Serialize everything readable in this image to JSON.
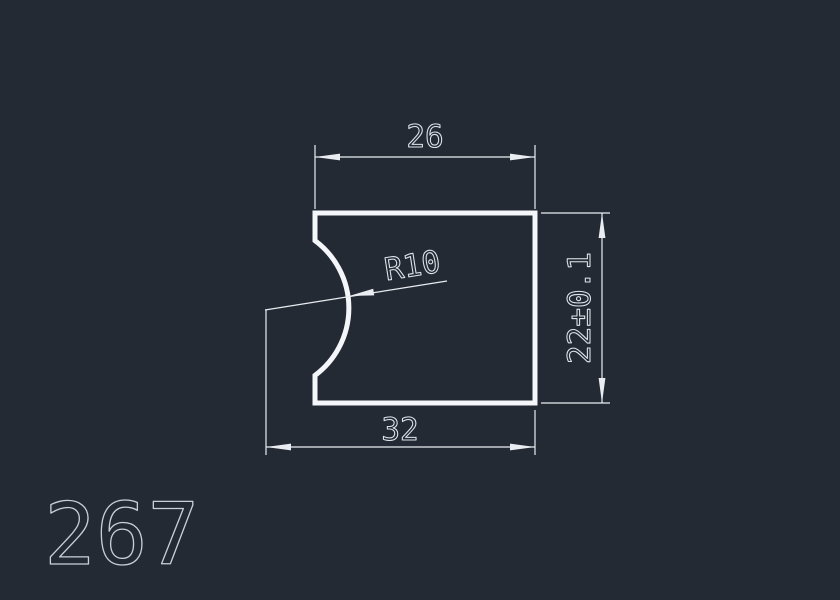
{
  "canvas": {
    "background_color": "#242a34",
    "outline_color": "#f4f6f9",
    "dimension_color": "#e9edf2",
    "text_color": "#dfe4ea",
    "label_color": "#c9cfd8"
  },
  "drawing": {
    "dimensions": {
      "top_width": {
        "label": "26"
      },
      "bottom_width": {
        "label": "32"
      },
      "height": {
        "label": "22±0.1"
      },
      "radius": {
        "label": "R10"
      }
    },
    "drawing_number": {
      "label": "267"
    }
  }
}
